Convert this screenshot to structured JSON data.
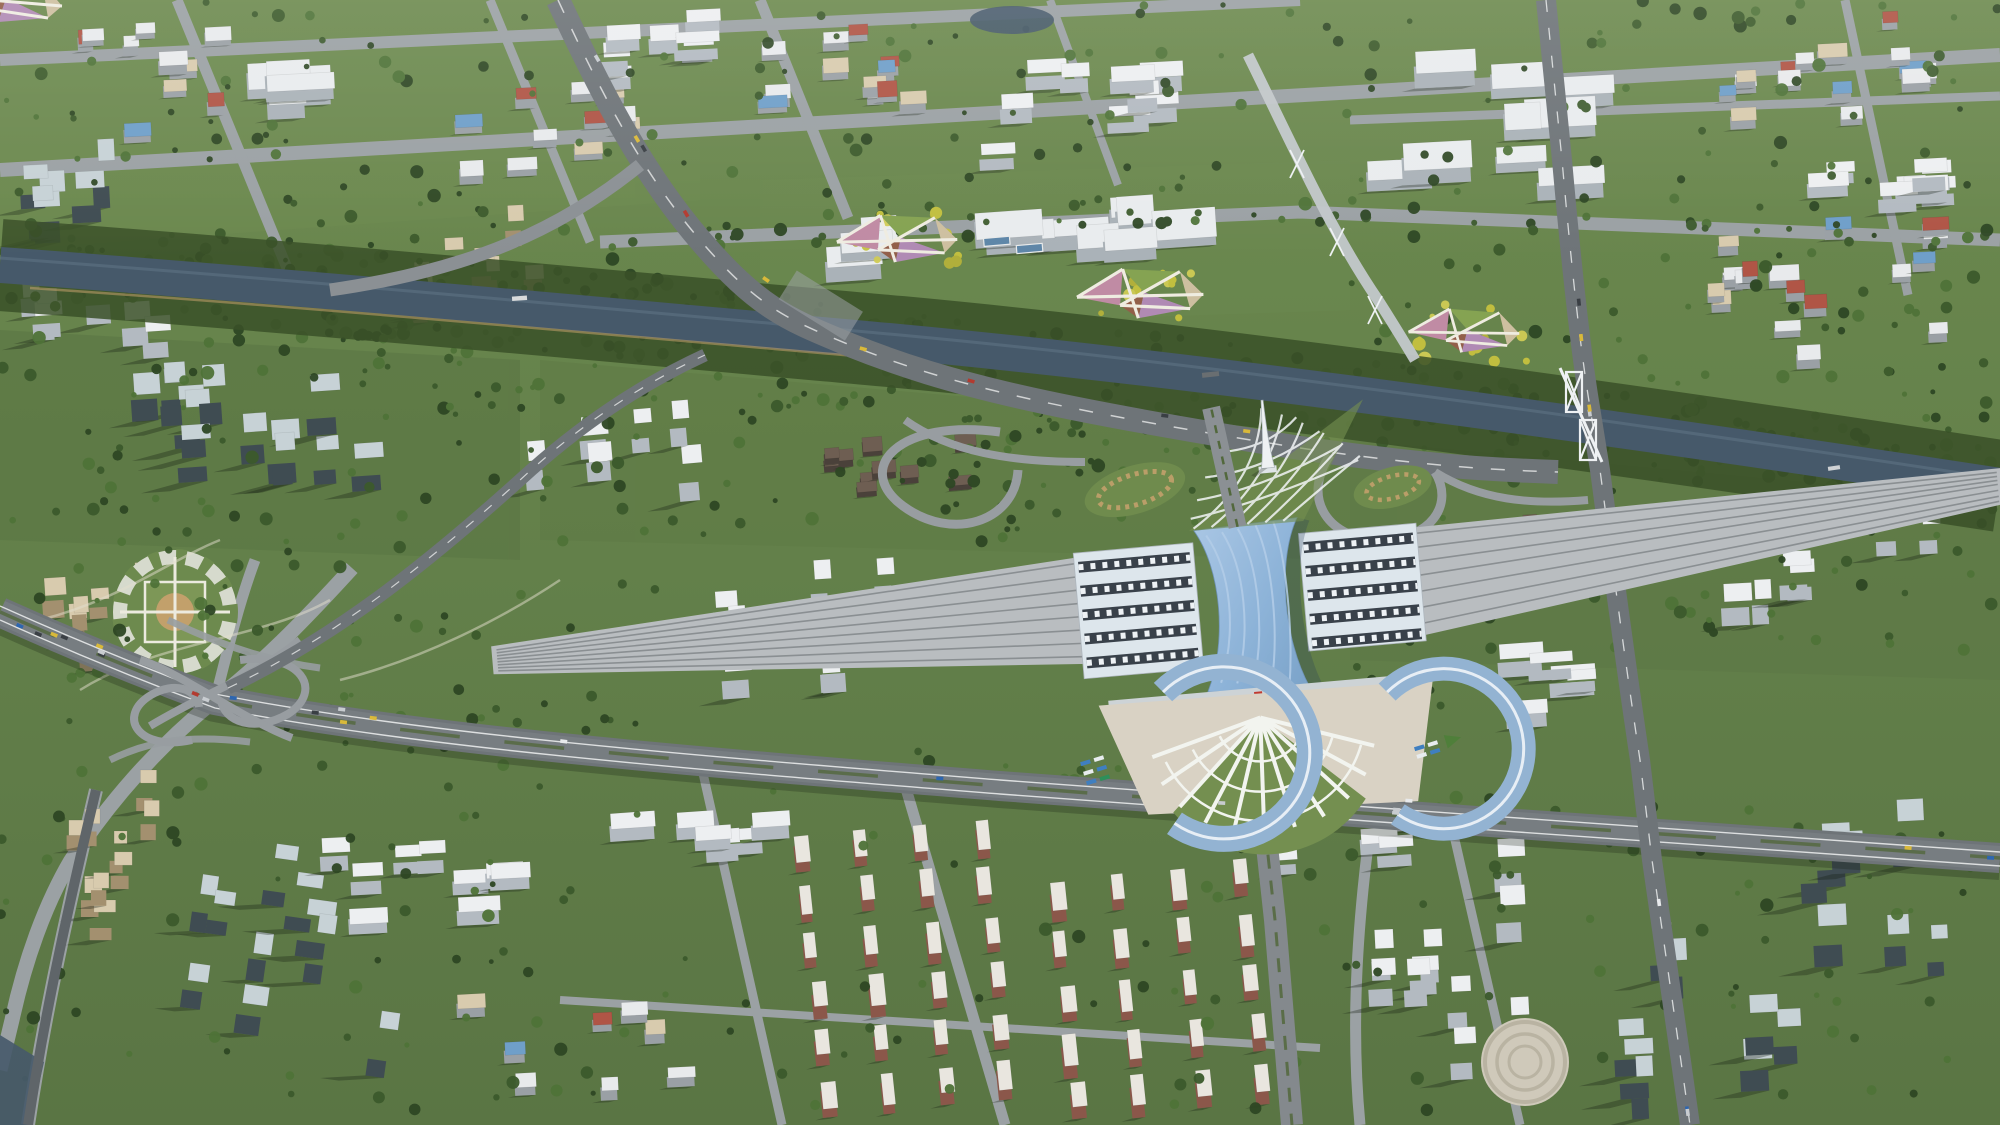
{
  "landmarks": {
    "station": "railway-station",
    "station_roof": "blue-wave-roof",
    "spire": "white-spire-monument",
    "lattice": "lattice-lawn-plaza",
    "fan_plaza": "radial-fan-south-plaza",
    "bus_loops": "blue-arc-bus-terminals",
    "river": "canal-river",
    "interchange": "cloverleaf-interchange",
    "truss_bridge": "truss-road-bridge",
    "flower_gardens": "diamond-flower-gardens",
    "round_plaza": "circular-garden-plaza"
  },
  "palette": {
    "grass_base": "#66814a",
    "grass_dark": "#55703c",
    "grass_light": "#73915270",
    "park": "#5d7843",
    "lawn": "#748f50",
    "tree_dark": "#2e4724",
    "tree_mid": "#3c5a2c",
    "tree_light": "#4f7338",
    "water": "#46596a",
    "water_light": "#5e7384",
    "road": "#84898d",
    "road_dark": "#6e7478",
    "road_mid": "#777d81",
    "road_light": "#9ba1a4",
    "lane_white": "#e8eaea",
    "median_green": "#52683c",
    "rail": "#b9bdc0",
    "rail_line": "#8a8f92",
    "paving": "#cfc8b8",
    "plaza": "#d9d2c4",
    "sand": "#c2a06b",
    "roof_white": "#edeff1",
    "face_white": "#b3bac1",
    "glass_face": "#3f4c52",
    "glass_roof": "#c7d2d6",
    "beige_face": "#a3906f",
    "beige_roof": "#d8cbae",
    "red_face": "#8b574a",
    "red_roof": "#b05546",
    "blue_roof": "#6f9fc9",
    "station_blue": "#8db3d8",
    "station_blue_hi": "#b3cde8",
    "station_blue_lo": "#7aa2c8",
    "canopy": "#dde6ec",
    "canopy_dark": "#39414a",
    "white": "#f2f4ef",
    "shadow": "rgba(22,32,20,0.32)",
    "flower_pink": "#c08ba4",
    "flower_green": "#85a352",
    "flower_mauve": "#b08ab4",
    "flower_brown": "#925f49",
    "flower_pale": "#cdbfa0",
    "tree_yellow": "#c6c23f"
  },
  "generate": {
    "types": {
      "glass": {
        "w": [
          16,
          30
        ],
        "h": [
          13,
          22
        ],
        "lift": [
          26,
          52
        ],
        "face": "#3f4c52",
        "roof": "#c7d2d6"
      },
      "white_tower": {
        "w": [
          16,
          28
        ],
        "h": [
          13,
          20
        ],
        "lift": [
          18,
          38
        ],
        "face": "#b3bac1",
        "roof": "#edeff1"
      },
      "beige": {
        "w": [
          13,
          22
        ],
        "h": [
          11,
          18
        ],
        "lift": [
          14,
          30
        ],
        "face": "#a3906f",
        "roof": "#d8cbae"
      },
      "white_slab": {
        "w": [
          26,
          46
        ],
        "h": [
          10,
          16
        ],
        "lift": [
          10,
          20
        ],
        "face": "#b3bac1",
        "roof": "#edeff1"
      },
      "campus": {
        "w": [
          34,
          72
        ],
        "h": [
          16,
          30
        ],
        "lift": [
          8,
          15
        ],
        "face": "#aab2b8",
        "roof": "#e9ecee"
      },
      "lowrise": {
        "w": [
          15,
          30
        ],
        "h": [
          10,
          16
        ],
        "lift": [
          5,
          10
        ],
        "face": "#9aa0a5",
        "roofs": [
          "#e8eaec",
          "#b05546",
          "#6f9fc9",
          "#d8cbae",
          "#e8eaec"
        ]
      },
      "redrow": {
        "w": [
          11,
          15
        ],
        "h": [
          24,
          32
        ],
        "lift": [
          8,
          13
        ],
        "face": "#8b574a",
        "roof": "#e9e6df"
      },
      "historic": {
        "w": [
          13,
          24
        ],
        "h": [
          9,
          15
        ],
        "lift": [
          4,
          7
        ],
        "face": "#4a413a",
        "roof": "#6e5e52"
      }
    },
    "districts": [
      {
        "x": 150,
        "y": 90,
        "w": 260,
        "h": 130,
        "rot": -3,
        "type": "lowrise",
        "count": 10,
        "seed": 11
      },
      {
        "x": 95,
        "y": 205,
        "w": 170,
        "h": 85,
        "rot": -3,
        "type": "glass",
        "count": 6,
        "seed": 12
      },
      {
        "x": 300,
        "y": 95,
        "w": 150,
        "h": 80,
        "rot": -3,
        "type": "campus",
        "count": 5,
        "seed": 13
      },
      {
        "x": 465,
        "y": 280,
        "w": 170,
        "h": 95,
        "rot": -3,
        "type": "beige",
        "count": 9,
        "seed": 14
      },
      {
        "x": 560,
        "y": 130,
        "w": 220,
        "h": 115,
        "rot": -3,
        "type": "lowrise",
        "count": 12,
        "seed": 15
      },
      {
        "x": 660,
        "y": 55,
        "w": 180,
        "h": 75,
        "rot": -3,
        "type": "white_slab",
        "count": 7,
        "seed": 16
      },
      {
        "x": 855,
        "y": 75,
        "w": 200,
        "h": 105,
        "rot": -3,
        "type": "lowrise",
        "count": 12,
        "seed": 17
      },
      {
        "x": 1000,
        "y": 248,
        "w": 480,
        "h": 65,
        "rot": -4,
        "type": "campus",
        "count": 11,
        "seed": 18
      },
      {
        "x": 1100,
        "y": 115,
        "w": 260,
        "h": 115,
        "rot": -3,
        "type": "white_slab",
        "count": 9,
        "seed": 19
      },
      {
        "x": 1500,
        "y": 140,
        "w": 280,
        "h": 175,
        "rot": -3,
        "type": "campus",
        "count": 9,
        "seed": 20
      },
      {
        "x": 1850,
        "y": 78,
        "w": 280,
        "h": 115,
        "rot": -3,
        "type": "lowrise",
        "count": 16,
        "seed": 21
      },
      {
        "x": 1800,
        "y": 300,
        "w": 360,
        "h": 145,
        "rot": -3,
        "type": "lowrise",
        "count": 18,
        "seed": 22
      },
      {
        "x": 1850,
        "y": 195,
        "w": 260,
        "h": 65,
        "rot": -3,
        "type": "white_slab",
        "count": 8,
        "seed": 23
      },
      {
        "x": 230,
        "y": 450,
        "w": 330,
        "h": 145,
        "rot": -4,
        "type": "glass",
        "count": 13,
        "seed": 24
      },
      {
        "x": 90,
        "y": 330,
        "w": 160,
        "h": 85,
        "rot": -4,
        "type": "white_tower",
        "count": 6,
        "seed": 25
      },
      {
        "x": 620,
        "y": 468,
        "w": 200,
        "h": 85,
        "rot": -5,
        "type": "white_tower",
        "count": 6,
        "seed": 26
      },
      {
        "x": 905,
        "y": 478,
        "w": 170,
        "h": 85,
        "rot": -5,
        "type": "historic",
        "count": 10,
        "seed": 27
      },
      {
        "x": 760,
        "y": 645,
        "w": 300,
        "h": 115,
        "rot": -4,
        "type": "white_tower",
        "count": 8,
        "seed": 28
      },
      {
        "x": 95,
        "y": 640,
        "w": 170,
        "h": 105,
        "rot": -4,
        "type": "beige",
        "count": 8,
        "seed": 29
      },
      {
        "x": 90,
        "y": 880,
        "w": 170,
        "h": 175,
        "rot": 0,
        "type": "beige",
        "count": 9,
        "seed": 30
      },
      {
        "x": 300,
        "y": 1000,
        "w": 240,
        "h": 225,
        "rot": 8,
        "type": "glass",
        "count": 10,
        "seed": 31
      },
      {
        "x": 430,
        "y": 895,
        "w": 260,
        "h": 155,
        "rot": -3,
        "type": "white_slab",
        "count": 9,
        "seed": 32
      },
      {
        "x": 575,
        "y": 1050,
        "w": 260,
        "h": 135,
        "rot": -3,
        "type": "lowrise",
        "count": 8,
        "seed": 33
      },
      {
        "x": 905,
        "y": 975,
        "w": 240,
        "h": 295,
        "rot": -6,
        "type": "redrow",
        "count": 24,
        "grid": [
          4,
          6
        ],
        "seed": 34
      },
      {
        "x": 1160,
        "y": 1000,
        "w": 250,
        "h": 255,
        "rot": -6,
        "type": "redrow",
        "count": 20,
        "grid": [
          4,
          5
        ],
        "seed": 35
      },
      {
        "x": 700,
        "y": 838,
        "w": 260,
        "h": 85,
        "rot": -4,
        "type": "white_slab",
        "count": 6,
        "seed": 36
      },
      {
        "x": 1800,
        "y": 980,
        "w": 380,
        "h": 275,
        "rot": -3,
        "type": "glass",
        "count": 15,
        "seed": 37
      },
      {
        "x": 1430,
        "y": 990,
        "w": 220,
        "h": 255,
        "rot": -3,
        "type": "white_tower",
        "count": 10,
        "seed": 38
      },
      {
        "x": 1830,
        "y": 560,
        "w": 240,
        "h": 135,
        "rot": -3,
        "type": "white_tower",
        "count": 8,
        "seed": 39
      },
      {
        "x": 1520,
        "y": 545,
        "w": 90,
        "h": 55,
        "rot": -4,
        "type": "historic",
        "count": 4,
        "seed": 41
      },
      {
        "x": 1560,
        "y": 690,
        "w": 200,
        "h": 75,
        "rot": -4,
        "type": "white_slab",
        "count": 5,
        "seed": 42
      },
      {
        "x": 1340,
        "y": 845,
        "w": 190,
        "h": 70,
        "rot": -4,
        "type": "white_slab",
        "count": 5,
        "seed": 43
      }
    ],
    "tree_belts": [
      {
        "rect": [
          0,
          0,
          700,
          310
        ],
        "count": 85,
        "seed": 101
      },
      {
        "rect": [
          700,
          0,
          650,
          235
        ],
        "count": 60,
        "seed": 102
      },
      {
        "rect": [
          1350,
          0,
          650,
          295
        ],
        "count": 80,
        "seed": 103
      },
      {
        "rect": [
          1350,
          300,
          650,
          165
        ],
        "count": 55,
        "seed": 104
      },
      {
        "rect": [
          0,
          320,
          500,
          235
        ],
        "count": 65,
        "seed": 105
      },
      {
        "rect": [
          30,
          560,
          640,
          175
        ],
        "count": 55,
        "seed": 106
      },
      {
        "rect": [
          520,
          380,
          500,
          165
        ],
        "count": 45,
        "seed": 107
      },
      {
        "rect": [
          1430,
          470,
          570,
          185
        ],
        "count": 50,
        "seed": 108
      },
      {
        "rect": [
          0,
          760,
          540,
          355
        ],
        "count": 55,
        "seed": 109
      },
      {
        "rect": [
          540,
          790,
          780,
          325
        ],
        "count": 45,
        "seed": 110
      },
      {
        "rect": [
          1320,
          850,
          680,
          265
        ],
        "count": 45,
        "seed": 111
      },
      {
        "pts": [
          [
            0,
            235
          ],
          [
            400,
            268
          ],
          [
            800,
            308
          ],
          [
            1200,
            352
          ],
          [
            1600,
            405
          ],
          [
            2000,
            462
          ]
        ],
        "spread": 14,
        "count": 110,
        "seed": 112
      },
      {
        "pts": [
          [
            0,
            292
          ],
          [
            400,
            322
          ],
          [
            800,
            362
          ],
          [
            1200,
            404
          ],
          [
            1600,
            455
          ],
          [
            2000,
            512
          ]
        ],
        "spread": 16,
        "count": 110,
        "seed": 113
      },
      {
        "pts": [
          [
            300,
            355
          ],
          [
            700,
            388
          ],
          [
            1100,
            420
          ],
          [
            1350,
            440
          ]
        ],
        "spread": 26,
        "count": 55,
        "seed": 114
      },
      {
        "pts": [
          [
            600,
            242
          ],
          [
            1300,
            212
          ],
          [
            2000,
            240
          ]
        ],
        "spread": 10,
        "count": 45,
        "seed": 115
      },
      {
        "pts": [
          [
            215,
            700
          ],
          [
            700,
            762
          ],
          [
            1300,
            800
          ],
          [
            2000,
            856
          ]
        ],
        "spread": 26,
        "count": 55,
        "seed": 116
      },
      {
        "rect": [
          840,
          212,
          130,
          55
        ],
        "count": 12,
        "seed": 117,
        "colors": [
          "#c6c23f",
          "#d0cc55",
          "#b5b23a"
        ]
      },
      {
        "rect": [
          1080,
          268,
          130,
          55
        ],
        "count": 12,
        "seed": 118,
        "colors": [
          "#c6c23f",
          "#d0cc55",
          "#b5b23a"
        ]
      },
      {
        "rect": [
          1400,
          303,
          130,
          60
        ],
        "count": 12,
        "seed": 119,
        "colors": [
          "#c6c23f",
          "#d0cc55",
          "#b5b23a"
        ]
      },
      {
        "rect": [
          880,
          428,
          340,
          115
        ],
        "count": 38,
        "seed": 120
      },
      {
        "rect": [
          1240,
          640,
          220,
          155
        ],
        "count": 20,
        "seed": 121
      }
    ],
    "car_paths": [
      {
        "pts": [
          [
            0,
            612
          ],
          [
            215,
            700
          ],
          [
            700,
            762
          ],
          [
            1300,
            800
          ],
          [
            2000,
            856
          ]
        ],
        "count": 22,
        "seed": 131
      },
      {
        "pts": [
          [
            558,
            0
          ],
          [
            700,
            240
          ],
          [
            850,
            345
          ],
          [
            1100,
            415
          ],
          [
            1558,
            472
          ]
        ],
        "count": 9,
        "seed": 132
      },
      {
        "pts": [
          [
            1546,
            0
          ],
          [
            1588,
            395
          ],
          [
            1640,
            760
          ],
          [
            1690,
            1125
          ]
        ],
        "count": 7,
        "seed": 133
      }
    ],
    "car_colors": [
      "#c8ccd0",
      "#b33b30",
      "#2d66b0",
      "#d9b93a",
      "#e8eaec",
      "#3a3f44"
    ]
  }
}
